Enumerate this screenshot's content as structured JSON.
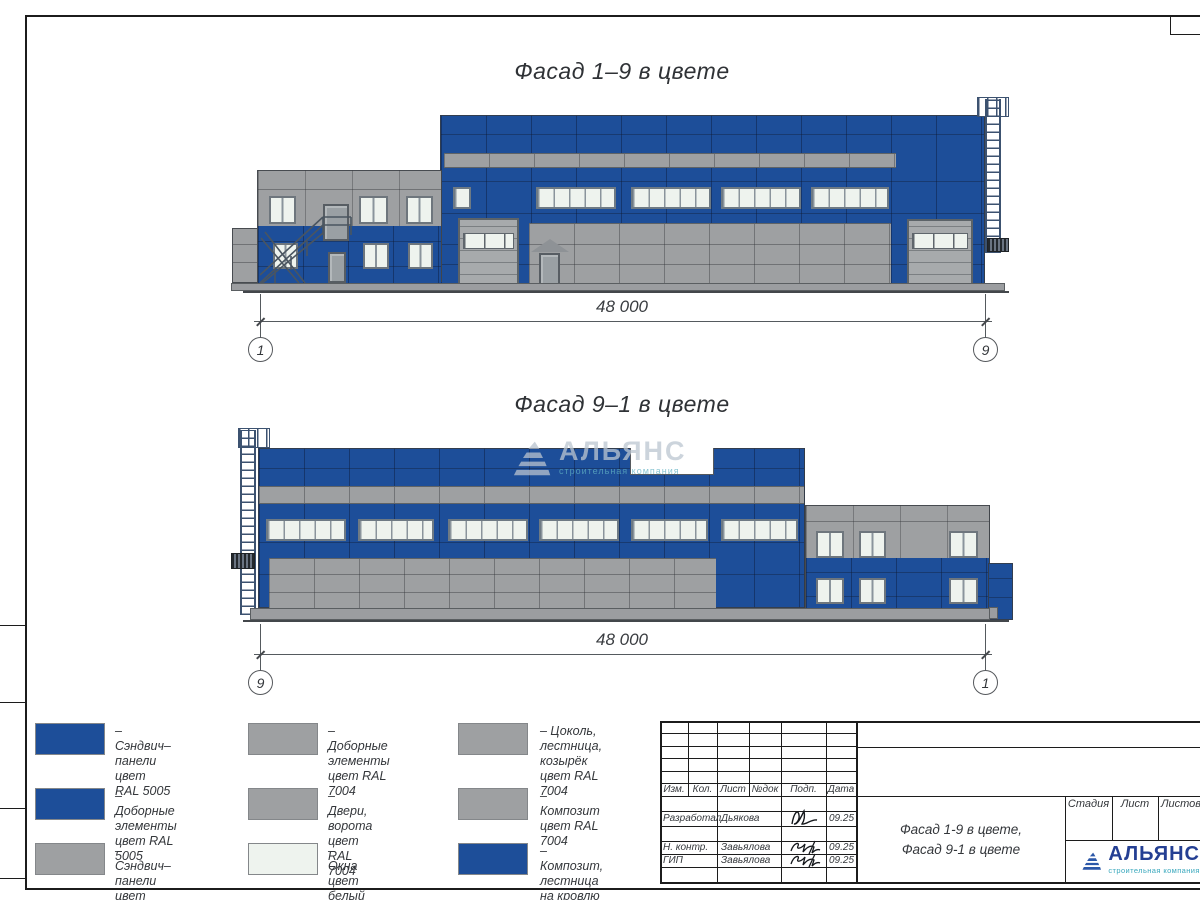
{
  "colors": {
    "panel_blue": "#1d4e99",
    "panel_gray": "#9ea0a2",
    "window_white": "#eef3ee",
    "logo_navy": "#243f93",
    "logo_teal": "#3aa8bd"
  },
  "titles": {
    "facade_top": "Фасад 1–9 в цвете",
    "facade_bottom": "Фасад 9–1 в цвете"
  },
  "dims": {
    "top": {
      "value": "48 000",
      "left_axis": "1",
      "right_axis": "9"
    },
    "bottom": {
      "value": "48 000",
      "left_axis": "9",
      "right_axis": "1"
    }
  },
  "legend": {
    "items": [
      {
        "color": "#1d4e99",
        "lines": [
          "– Сэндвич–панели",
          "цвет RAL 5005",
          ""
        ]
      },
      {
        "color": "#9ea0a2",
        "lines": [
          "– Доборные элементы",
          "цвет RAL 7004",
          ""
        ]
      },
      {
        "color": "#9ea0a2",
        "lines": [
          "– Цоколь, лестница,",
          "козырёк",
          "цвет RAL 7004"
        ]
      },
      {
        "color": "#1d4e99",
        "lines": [
          "– Доборные элементы",
          "цвет RAL 5005",
          ""
        ]
      },
      {
        "color": "#9ea0a2",
        "lines": [
          "– Двери, ворота",
          "цвет RAL 7004",
          ""
        ]
      },
      {
        "color": "#9ea0a2",
        "lines": [
          "– Композит",
          "цвет RAL 7004",
          ""
        ]
      },
      {
        "color": "#9ea0a2",
        "lines": [
          "– Сэндвич–панели",
          "цвет RAL 7004",
          ""
        ]
      },
      {
        "color": "#eef3ee",
        "lines": [
          "– Окна",
          "цвет белый",
          ""
        ]
      },
      {
        "color": "#1d4e99",
        "lines": [
          "– Композит,",
          "лестница на кровлю",
          "цвет RAL 5005"
        ]
      }
    ]
  },
  "title_block": {
    "headers": [
      "Изм.",
      "Кол.",
      "Лист",
      "№док",
      "Подп.",
      "Дата"
    ],
    "rows": [
      {
        "role": "Разработал",
        "name": "Дьякова",
        "date": "09.25"
      },
      {
        "role": "Н. контр.",
        "name": "Завьялова",
        "date": "09.25"
      },
      {
        "role": "ГИП",
        "name": "Завьялова",
        "date": "09.25"
      }
    ],
    "sheet_title_line1": "Фасад 1-9 в цвете,",
    "sheet_title_line2": "Фасад 9-1 в цвете",
    "stage_headers": [
      "Стадия",
      "Лист",
      "Листов"
    ],
    "logo": {
      "name": "АЛЬЯНС",
      "subtitle": "строительная компания"
    }
  },
  "watermark": {
    "name": "АЛЬЯНС",
    "subtitle": "строительная компания"
  }
}
